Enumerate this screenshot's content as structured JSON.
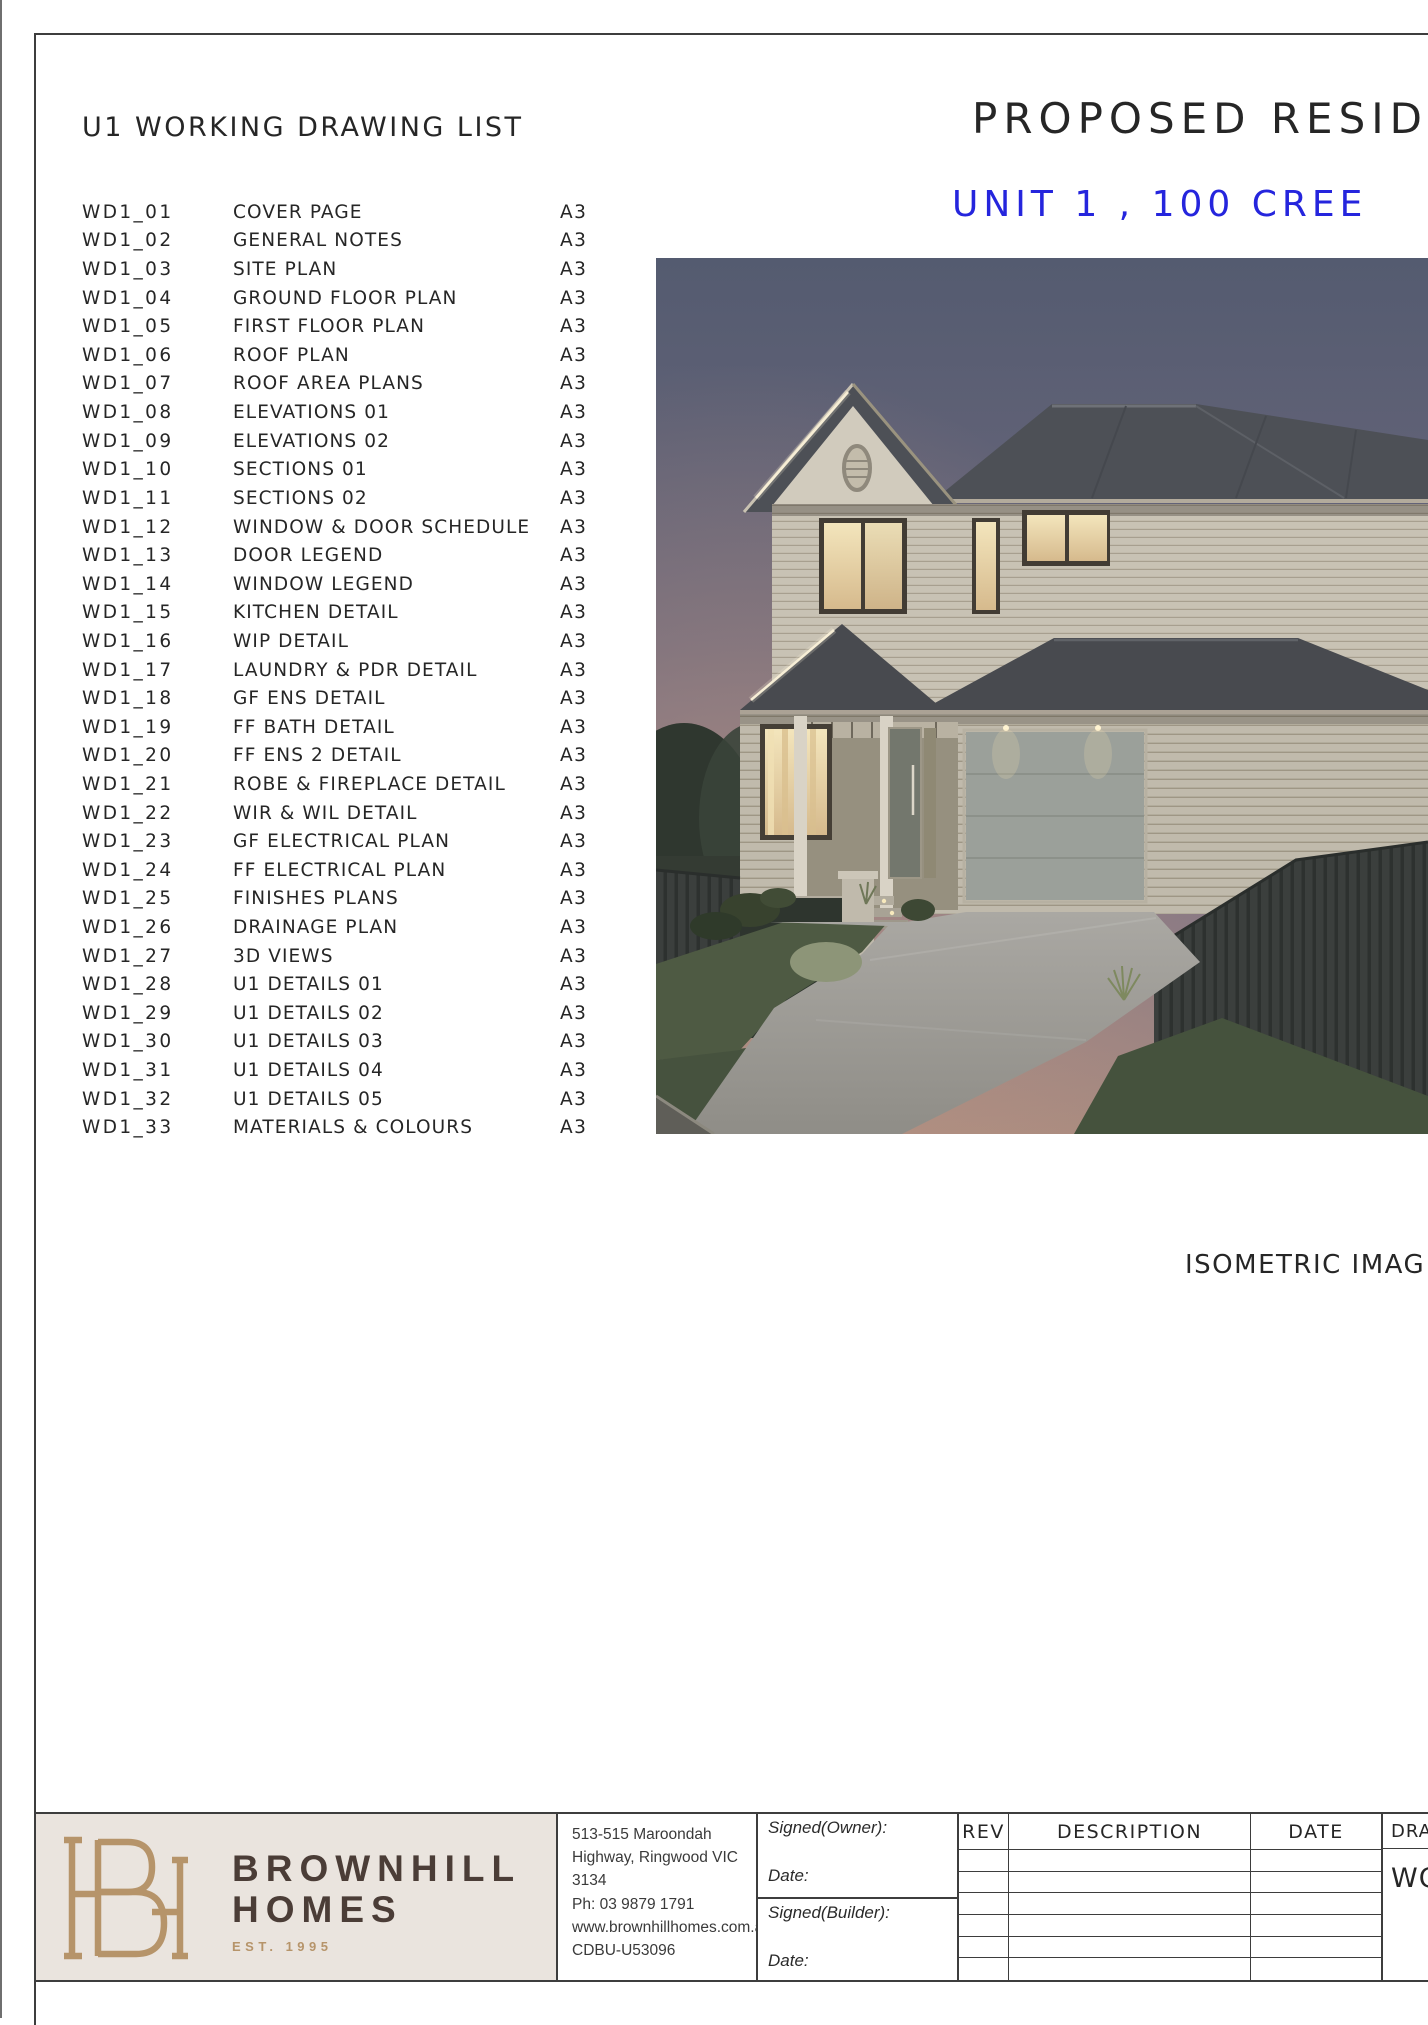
{
  "sheet": {
    "drawing_list": {
      "heading": "U1 WORKING DRAWING LIST",
      "rows": [
        {
          "no": "WD1_01",
          "title": "COVER PAGE",
          "size": "A3"
        },
        {
          "no": "WD1_02",
          "title": "GENERAL NOTES",
          "size": "A3"
        },
        {
          "no": "WD1_03",
          "title": "SITE PLAN",
          "size": "A3"
        },
        {
          "no": "WD1_04",
          "title": "GROUND FLOOR PLAN",
          "size": "A3"
        },
        {
          "no": "WD1_05",
          "title": "FIRST FLOOR PLAN",
          "size": "A3"
        },
        {
          "no": "WD1_06",
          "title": "ROOF PLAN",
          "size": "A3"
        },
        {
          "no": "WD1_07",
          "title": "ROOF AREA PLANS",
          "size": "A3"
        },
        {
          "no": "WD1_08",
          "title": "ELEVATIONS 01",
          "size": "A3"
        },
        {
          "no": "WD1_09",
          "title": "ELEVATIONS 02",
          "size": "A3"
        },
        {
          "no": "WD1_10",
          "title": "SECTIONS 01",
          "size": "A3"
        },
        {
          "no": "WD1_11",
          "title": "SECTIONS 02",
          "size": "A3"
        },
        {
          "no": "WD1_12",
          "title": "WINDOW & DOOR SCHEDULE",
          "size": "A3"
        },
        {
          "no": "WD1_13",
          "title": "DOOR LEGEND",
          "size": "A3"
        },
        {
          "no": "WD1_14",
          "title": "WINDOW LEGEND",
          "size": "A3"
        },
        {
          "no": "WD1_15",
          "title": "KITCHEN  DETAIL",
          "size": "A3"
        },
        {
          "no": "WD1_16",
          "title": "WIP DETAIL",
          "size": "A3"
        },
        {
          "no": "WD1_17",
          "title": "LAUNDRY & PDR DETAIL",
          "size": "A3"
        },
        {
          "no": "WD1_18",
          "title": "GF ENS DETAIL",
          "size": "A3"
        },
        {
          "no": "WD1_19",
          "title": "FF BATH  DETAIL",
          "size": "A3"
        },
        {
          "no": "WD1_20",
          "title": "FF ENS 2 DETAIL",
          "size": "A3"
        },
        {
          "no": "WD1_21",
          "title": "ROBE & FIREPLACE DETAIL",
          "size": "A3"
        },
        {
          "no": "WD1_22",
          "title": "WIR & WIL DETAIL",
          "size": "A3"
        },
        {
          "no": "WD1_23",
          "title": "GF ELECTRICAL PLAN",
          "size": "A3"
        },
        {
          "no": "WD1_24",
          "title": "FF ELECTRICAL PLAN",
          "size": "A3"
        },
        {
          "no": "WD1_25",
          "title": "FINISHES PLANS",
          "size": "A3"
        },
        {
          "no": "WD1_26",
          "title": "DRAINAGE PLAN",
          "size": "A3"
        },
        {
          "no": "WD1_27",
          "title": "3D VIEWS",
          "size": "A3"
        },
        {
          "no": "WD1_28",
          "title": "U1 DETAILS 01",
          "size": "A3"
        },
        {
          "no": "WD1_29",
          "title": "U1 DETAILS 02",
          "size": "A3"
        },
        {
          "no": "WD1_30",
          "title": "U1 DETAILS 03",
          "size": "A3"
        },
        {
          "no": "WD1_31",
          "title": "U1 DETAILS 04",
          "size": "A3"
        },
        {
          "no": "WD1_32",
          "title": "U1 DETAILS 05",
          "size": "A3"
        },
        {
          "no": "WD1_33",
          "title": "MATERIALS & COLOURS",
          "size": "A3"
        }
      ]
    },
    "project": {
      "title": "PROPOSED RESID",
      "subtitle": "UNIT 1 , 100 CREE",
      "subtitle_color": "#2525dd"
    },
    "photo": {
      "name": "house-dusk-render",
      "caption": "ISOMETRIC IMAG"
    },
    "brand": {
      "monogram": "BH",
      "name_top": "BROWNHILL",
      "name_bottom": "HOMES",
      "est": "EST. 1995",
      "gold": "#b6946a",
      "brown": "#4b3d37",
      "bg": "#eae4de"
    },
    "contact": {
      "lines": [
        "513-515 Maroondah",
        "Highway, Ringwood VIC 3134",
        "Ph: 03 9879 1791",
        "www.brownhillhomes.com.au",
        "CDBU-U53096"
      ]
    },
    "signature": {
      "owner": "Signed(Owner):",
      "owner_date": "Date:",
      "builder": "Signed(Builder):",
      "builder_date": "Date:"
    },
    "revision_table": {
      "headers": [
        "REV",
        "DESCRIPTION",
        "DATE"
      ],
      "empty_row_count": 6
    },
    "drawing_info": {
      "header": "DRAW",
      "value": "WO"
    }
  }
}
